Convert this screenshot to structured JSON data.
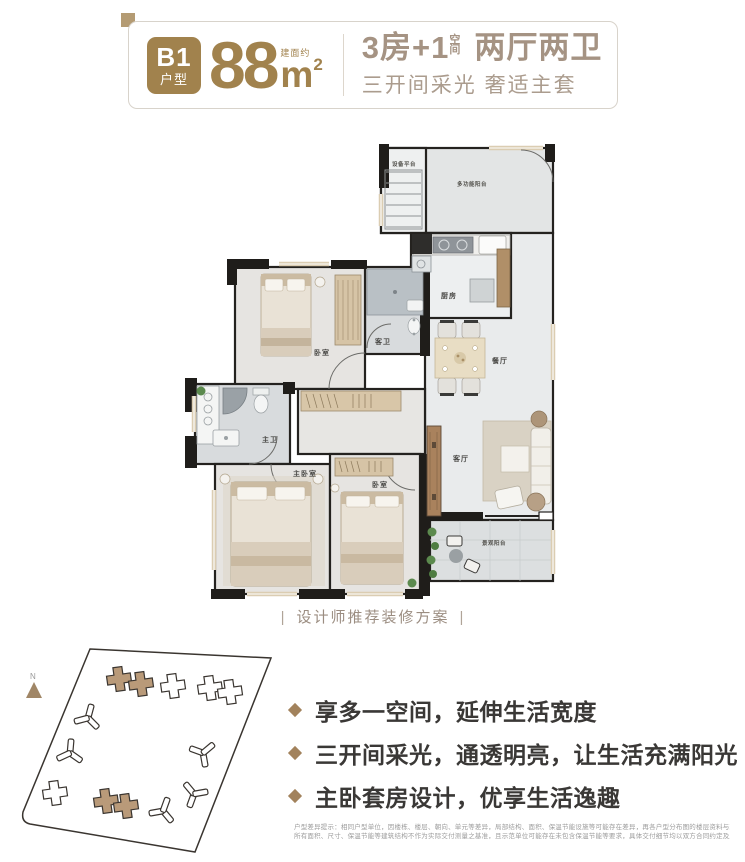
{
  "header": {
    "badge": {
      "line1": "B1",
      "line2": "户型"
    },
    "area": {
      "prefix": "建面约",
      "value": "88",
      "unit": "m",
      "sup": "2"
    },
    "title": {
      "part1": "3房+1",
      "sup_top": "空",
      "sup_bottom": "间",
      "part2": "两厅两卫"
    },
    "subtitle": "三开间采光 奢适主套"
  },
  "floor_plan": {
    "caption": "设计师推荐装修方案",
    "caption_bar": "|",
    "rooms": {
      "equipment_platform": "设备平台",
      "multi_balcony": "多功能阳台",
      "kitchen": "厨房",
      "guest_bath": "客卫",
      "bedroom_top": "卧室",
      "dining": "餐厅",
      "master_bath": "主卫",
      "master_bedroom": "主卧室",
      "bedroom_second": "卧室",
      "living": "客厅",
      "view_balcony": "景观阳台"
    }
  },
  "site_plan": {
    "north": "N"
  },
  "selling_points": [
    {
      "text": "享多一空间，延伸生活宽度"
    },
    {
      "text": "三开间采光，通透明亮，让生活充满阳光"
    },
    {
      "text": "主卧套房设计，优享生活逸趣"
    }
  ],
  "disclaimer": {
    "line1": "户型差异提示：相同户型单位，因楼栋、楼层、朝向、单元等差异，局部结构、面积、保温节能设施等可能存在差异，再各户型分布图的楼层资料与现场示范单位展示也有可能存在细微差异，室内外",
    "line2": "所有面积、尺寸、保温节能等建筑结构不作为实际交付测量之基准，且示范单位可能存在未包含保温节能等要求，具体交付细节均以双方合同约定及所属建筑面积测绘结果报告书为准。"
  },
  "colors": {
    "gold": "#a1824d",
    "taupe_title": "#a59383",
    "corner_accent": "#b49b73",
    "bullet_diamond": "#a2825c",
    "body_text": "#3a3836",
    "caption": "#9b8d81",
    "disclaimer": "#9c9c9c",
    "wall": "#1f1d1a",
    "window_frame": "#dbcdb2",
    "highlight_building": "#b99a79",
    "plant_green": "#5c8a4e"
  }
}
